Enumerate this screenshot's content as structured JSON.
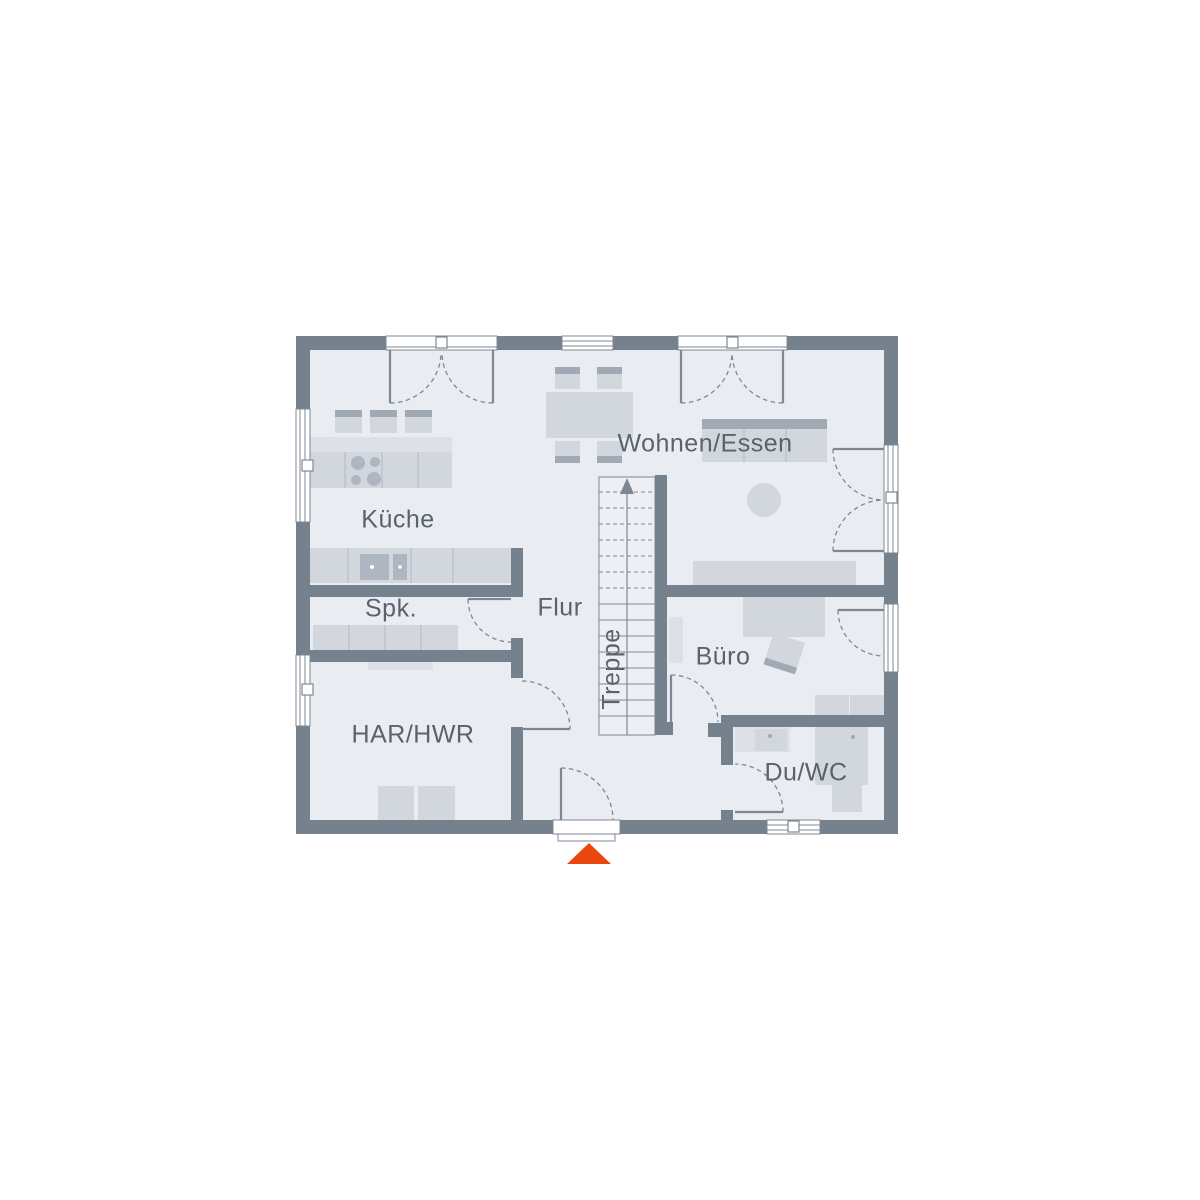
{
  "plan": {
    "rooms": [
      {
        "id": "kueche",
        "label": "Küche"
      },
      {
        "id": "wohnen_essen",
        "label": "Wohnen/Essen"
      },
      {
        "id": "spk",
        "label": "Spk."
      },
      {
        "id": "flur",
        "label": "Flur"
      },
      {
        "id": "treppe",
        "label": "Treppe"
      },
      {
        "id": "buero",
        "label": "Büro"
      },
      {
        "id": "har_hwr",
        "label": "HAR/HWR"
      },
      {
        "id": "du_wc",
        "label": "Du/WC"
      }
    ]
  },
  "icons": {
    "entrance_marker": "entrance-arrow",
    "stair_direction": "up-arrow"
  },
  "colors": {
    "wall": "#76818E",
    "floor": "#E9ECF1",
    "stairsfloor": "#EDEFF4",
    "furn": "#D2D6DD",
    "furndark": "#A0A9B4",
    "furnlight": "#DDE1E7",
    "appliance": "#AEB6C1",
    "divider": "#B9BFC9",
    "line": "#7E8894",
    "text": "#5A626E",
    "accent": "#E8470E"
  }
}
